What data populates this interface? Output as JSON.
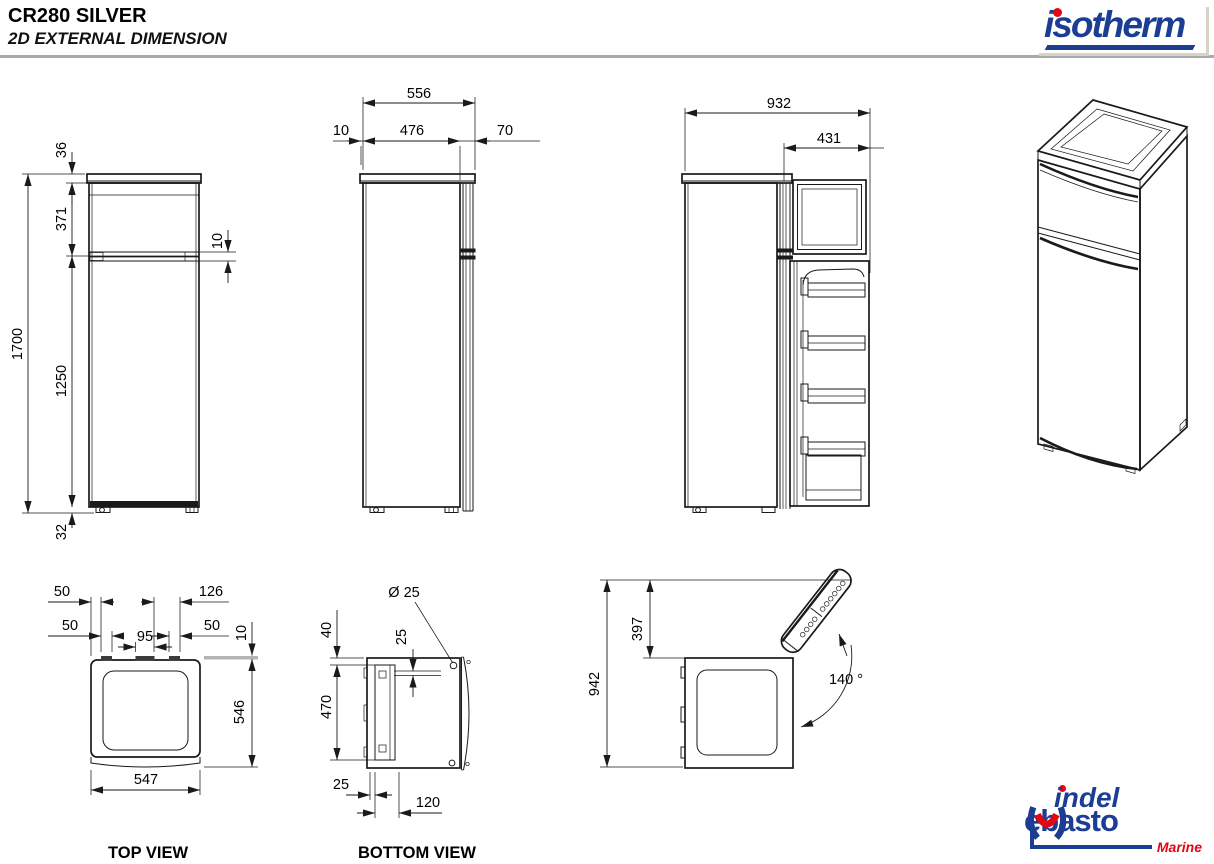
{
  "header": {
    "title": "CR280 SILVER",
    "subtitle": "2D EXTERNAL DIMENSION"
  },
  "logos": {
    "isotherm": {
      "text": "isotherm",
      "blue": "#1b3e94",
      "red": "#e30613"
    },
    "indel_webasto": {
      "top": "indel",
      "bottom": "ebasto",
      "tagline": "Marine"
    }
  },
  "front_view": {
    "cap_height": "36",
    "upper_door_height": "371",
    "door_gap": "10",
    "total_height": "1700",
    "lower_door_height": "1250",
    "feet_height": "32"
  },
  "side_view": {
    "total_depth": "556",
    "rear_gap": "10",
    "body_depth": "476",
    "door_depth": "70"
  },
  "open_side_view": {
    "depth_door_open": "932",
    "door_width": "431"
  },
  "top_view": {
    "label": "TOP VIEW",
    "dim_edge_to_hinge": "50",
    "dim_hinge_span_right": "126",
    "dim_left_hinge_width": "50",
    "dim_center_hinge_width": "95",
    "dim_right_hinge_width": "50",
    "dim_wall_clearance": "10",
    "dim_depth": "546",
    "dim_width": "547"
  },
  "bottom_view": {
    "label": "BOTTOM VIEW",
    "dim_hole_diameter": "Ø 25",
    "dim_top_offset": "40",
    "dim_hole_offset": "25",
    "dim_plate_length": "470",
    "dim_side_offset": "25",
    "dim_plate_width": "120"
  },
  "door_swing_view": {
    "dim_total_depth": "942",
    "dim_door_projection": "397",
    "dim_opening_angle": "140 °"
  }
}
